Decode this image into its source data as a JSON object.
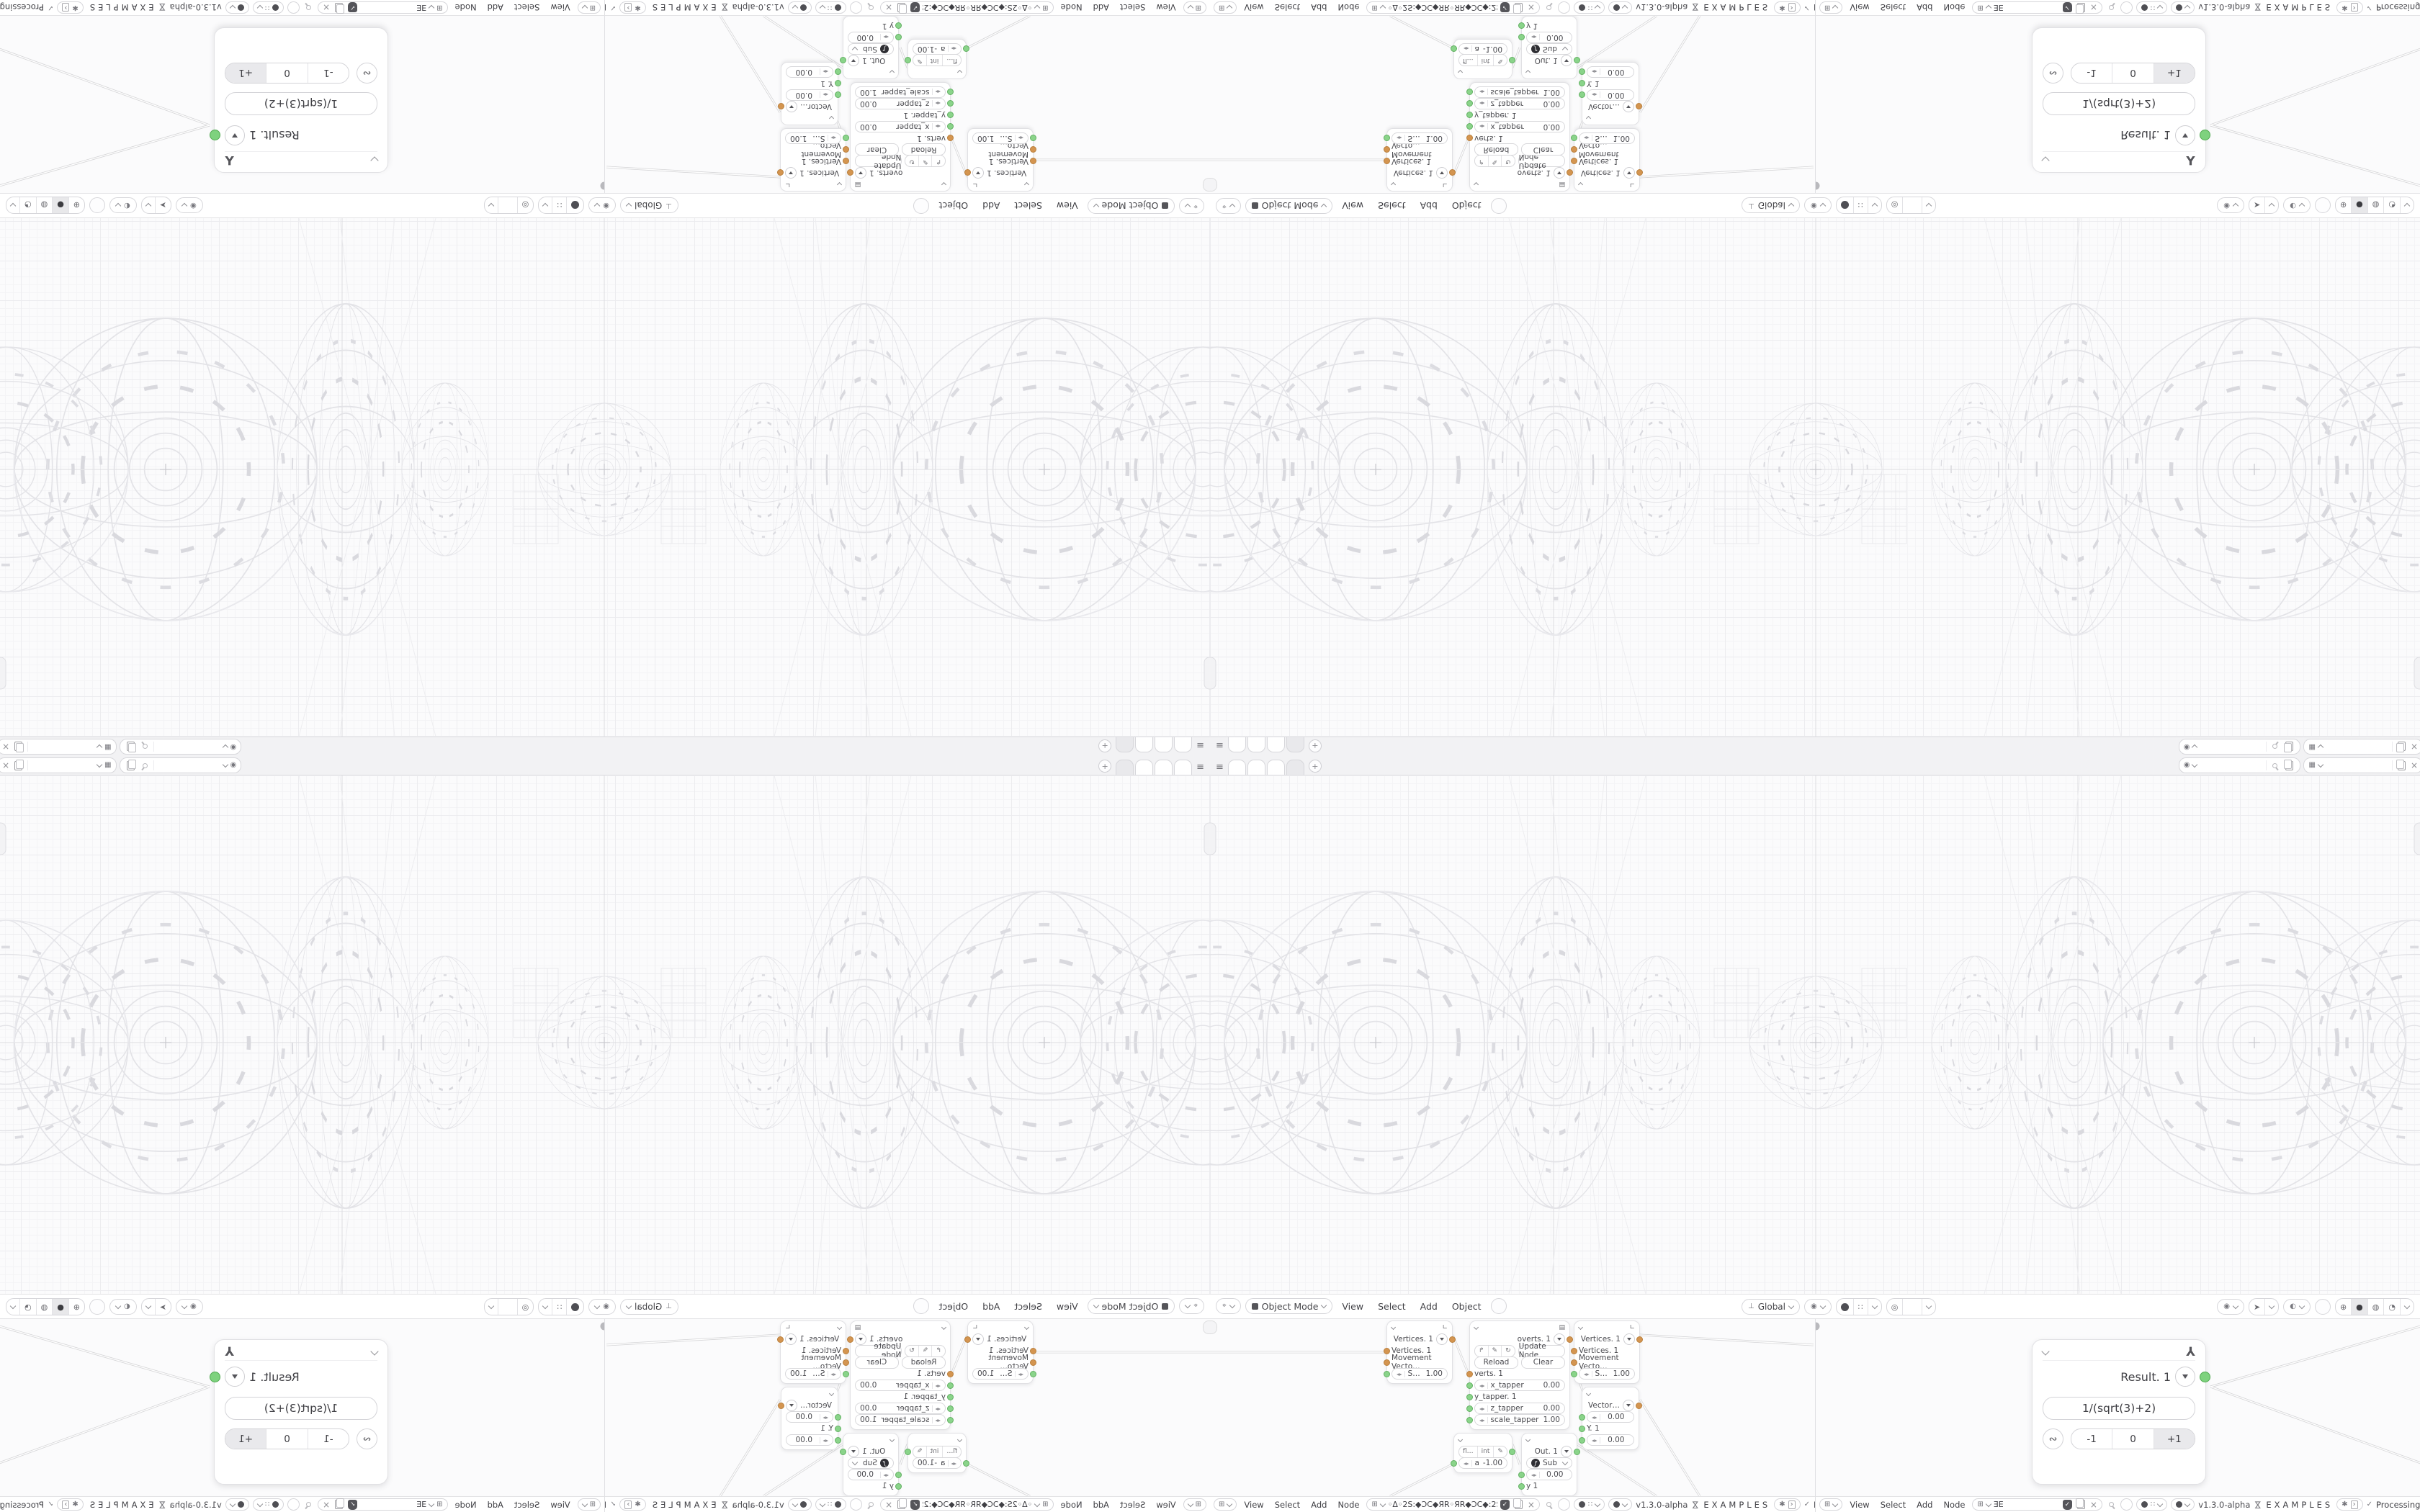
{
  "meta": {
    "description": "Kaleidoscope-mirrored screenshot of a Blender-style node tool: one base window tiled 2x2 with horizontal and vertical mirroring"
  },
  "icons": {
    "menu": "≡",
    "plus": "+",
    "scene": "◉",
    "layer": "▦",
    "editor_view": "⌖",
    "editor_node": "⊞",
    "mode_square": "",
    "orientation": "⊥",
    "pivot": "◉",
    "magnet": "∩",
    "snapgrid": "∷",
    "propedit": "◎",
    "eye": "◉",
    "tool": "➤",
    "overlay": "◐",
    "shade_wire": "⊕",
    "shade_solid": "●",
    "shade_material": "◍",
    "shade_rendered": "◔",
    "axes": "∟",
    "result_axes": "⅄",
    "script": "▤",
    "drag": "◂▸",
    "fn": "ƒ",
    "loop": "∾",
    "hourglass": "⋈",
    "spark": "✱",
    "prompt": "›",
    "arrow_in": "↱",
    "pencil": "✎",
    "refresh": "↻",
    "check": "✓",
    "close": "×",
    "shield_check": "✓"
  },
  "colors": {
    "socket_green": "#8ad48a",
    "socket_green_big": "#7ed27e",
    "socket_orange": "#d49550",
    "grid_major": "#ececef",
    "grid_minor": "#f4f4f6",
    "wire": "#d4d4d6",
    "node_bg": "#ffffff"
  },
  "topbar": {
    "workspace_tabs": [
      "",
      "",
      "",
      ""
    ],
    "active_tab_index": 3,
    "scene_selector": {
      "value": ""
    },
    "view_layer_selector": {
      "value": ""
    }
  },
  "viewport": {
    "header": {
      "mode_label": "Object Mode",
      "menus": [
        "View",
        "Select",
        "Add",
        "Object"
      ],
      "orientation_label": "Global"
    }
  },
  "node_editor_left": {
    "header": {
      "menus": [
        "View",
        "Select",
        "Add",
        "Node"
      ],
      "tree_name": "◦Δ◦2S:◆ƆC◆ЯR◦ЯR◆ƆC◆:2S◦Δ◦",
      "version": "v1.3.0-alpha",
      "examples_label": "EXAMPLES",
      "status_label": "Processing"
    },
    "nodes": {
      "vertices": {
        "title": "Vertices. 1",
        "inputs": [
          "Vertices. 1",
          "Movement Vecto…"
        ],
        "stren_label": "Stren",
        "stren_value": "1.00"
      },
      "script": {
        "title": "overts. 1",
        "update_label": "Update Node",
        "reload_label": "Reload",
        "clear_label": "Clear",
        "verts_label": "verts. 1",
        "x_label": "x_tapper",
        "x_value": "0.00",
        "y_label": "y_tapper. 1",
        "z_label": "z_tapper",
        "z_value": "0.00",
        "scale_label": "scale_tapper",
        "scale_value": "1.00"
      },
      "vector": {
        "title": "Vector…",
        "v1": "0.00",
        "y_label": "Y. 1",
        "v2": "0.00"
      },
      "math": {
        "tab1": "fl…",
        "tab2": "int",
        "field_label": "a",
        "field_value": "-1.00"
      },
      "out": {
        "title": "Out. 1",
        "op_label": "Sub",
        "value": "0.00",
        "y_label": "y 1"
      }
    }
  },
  "node_editor_right": {
    "header": {
      "menus": [
        "View",
        "Select",
        "Add",
        "Node"
      ],
      "tree_name": "ƎE",
      "version": "v1.3.0-alpha",
      "examples_label": "EXAMPLES",
      "status_label": "Processing"
    },
    "result_node": {
      "title": "Result. 1",
      "formula": "1/(sqrt(3)+2)",
      "buttons": [
        "-1",
        "0",
        "+1"
      ],
      "pressed_index": 2
    }
  }
}
